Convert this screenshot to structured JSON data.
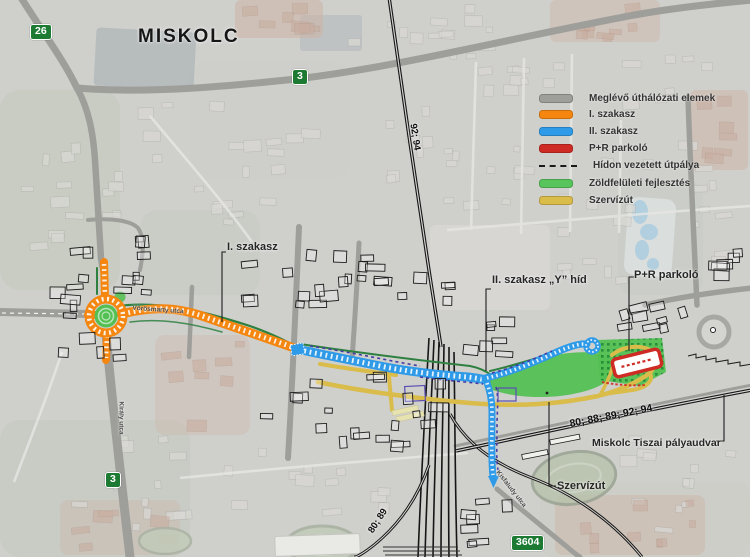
{
  "title": "MISKOLC",
  "legend": {
    "items": [
      {
        "label": "Meglévő úthálózati elemek",
        "color": "#9E9E9B",
        "type": "swatch"
      },
      {
        "label": "I. szakasz",
        "color": "#F5860F",
        "type": "swatch"
      },
      {
        "label": "II. szakasz",
        "color": "#2F9BE8",
        "type": "swatch"
      },
      {
        "label": "P+R parkoló",
        "color": "#CE2B24",
        "type": "swatch"
      },
      {
        "label": "Hídon vezetett útpálya",
        "color": "#1A1A1A",
        "type": "dash"
      },
      {
        "label": "Zöldfelületi fejlesztés",
        "color": "#57C45C",
        "type": "swatch"
      },
      {
        "label": "Szervízút",
        "color": "#D9BC4A",
        "type": "swatch"
      }
    ]
  },
  "badges": {
    "b26": "26",
    "b3_top": "3",
    "b3_left": "3",
    "b3604": "3604"
  },
  "callouts": {
    "phase1": "I. szakasz",
    "phase2": "II. szakasz „Y” híd",
    "pr": "P+R parkoló",
    "station": "Miskolc Tiszai pályaudvar",
    "service": "Szervízút"
  },
  "street_labels": {
    "vorosmarty": "Vörösmarty utca",
    "kiraly": "Király utca",
    "kisfaludy": "Kisfaludy utca"
  },
  "railway_labels": {
    "r92_94": "92; 94",
    "r80_89": "80; 89",
    "r_main": "80; 88; 89; 92; 94"
  },
  "colors": {
    "existing": "#9E9E9B",
    "phase1": "#F5860F",
    "phase2": "#2F9BE8",
    "pr": "#CE2B24",
    "bridge": "#443CA6",
    "green": "#54C053",
    "service": "#D9BC4A",
    "rail": "#161616",
    "badge_green": "#1C7A33"
  }
}
